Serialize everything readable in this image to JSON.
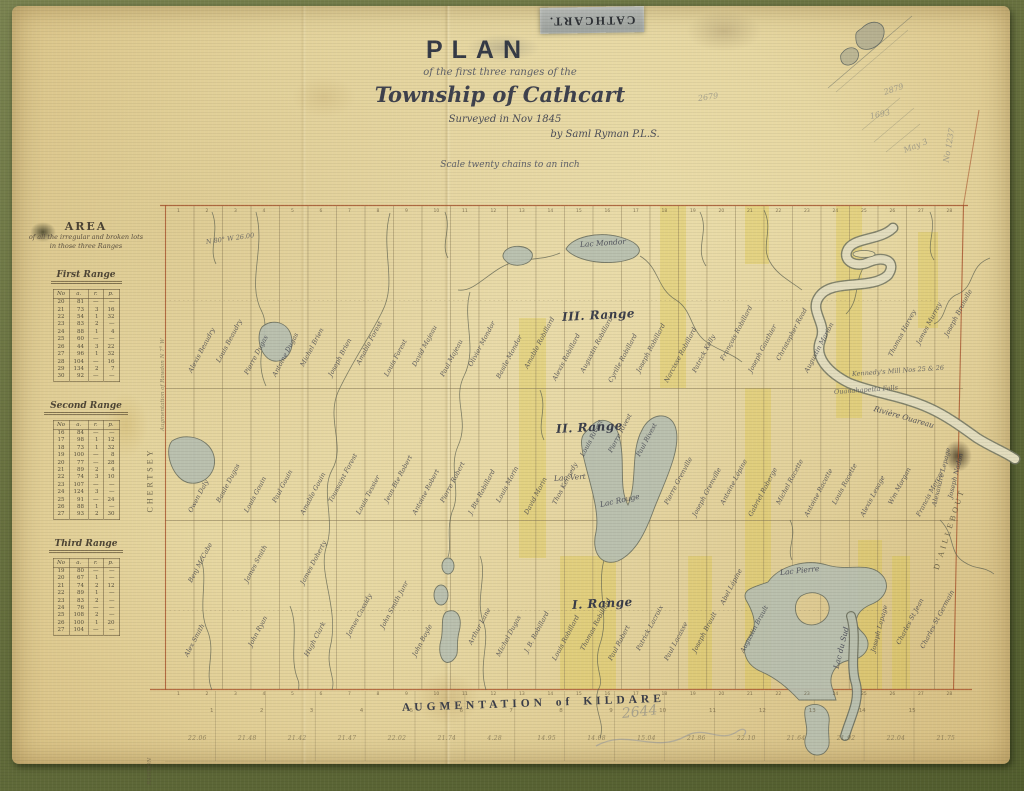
{
  "header": {
    "tape": "CATHCART.",
    "plan": "PLAN",
    "line2": "of the first three ranges of the",
    "township": "Township of Cathcart",
    "surveyed": "Surveyed in Nov 1845",
    "by": "by Saml Ryman P.L.S.",
    "scale": "Scale twenty chains to an inch"
  },
  "area": {
    "title": "AREA",
    "subtitle": "of all the irregular and broken lots",
    "subtitle2": "in those three Ranges",
    "col_no": "No",
    "unit_header": [
      "a.",
      "r.",
      "p."
    ],
    "sections": [
      {
        "name": "First Range",
        "rows": [
          [
            "20",
            "81",
            "—",
            "—"
          ],
          [
            "21",
            "73",
            "3",
            "16"
          ],
          [
            "22",
            "54",
            "1",
            "32"
          ],
          [
            "23",
            "83",
            "2",
            "—"
          ],
          [
            "24",
            "88",
            "1",
            "4"
          ],
          [
            "25",
            "60",
            "—",
            "—"
          ],
          [
            "26",
            "44",
            "3",
            "22"
          ],
          [
            "27",
            "96",
            "1",
            "32"
          ],
          [
            "28",
            "104",
            "—",
            "16"
          ],
          [
            "29",
            "134",
            "2",
            "7"
          ],
          [
            "30",
            "92",
            "—",
            "—"
          ]
        ]
      },
      {
        "name": "Second Range",
        "rows": [
          [
            "16",
            "84",
            "—",
            "—"
          ],
          [
            "17",
            "98",
            "1",
            "12"
          ],
          [
            "18",
            "73",
            "1",
            "32"
          ],
          [
            "19",
            "100",
            "—",
            "8"
          ],
          [
            "20",
            "77",
            "—",
            "28"
          ],
          [
            "21",
            "89",
            "2",
            "4"
          ],
          [
            "22",
            "74",
            "3",
            "10"
          ],
          [
            "23",
            "107",
            "—",
            "—"
          ],
          [
            "24",
            "124",
            "3",
            "—"
          ],
          [
            "25",
            "91",
            "—",
            "24"
          ],
          [
            "26",
            "88",
            "1",
            "—"
          ],
          [
            "27",
            "93",
            "2",
            "30"
          ]
        ]
      },
      {
        "name": "Third Range",
        "rows": [
          [
            "19",
            "80",
            "—",
            "—"
          ],
          [
            "20",
            "67",
            "1",
            "—"
          ],
          [
            "21",
            "74",
            "2",
            "12"
          ],
          [
            "22",
            "89",
            "1",
            "—"
          ],
          [
            "23",
            "83",
            "2",
            "—"
          ],
          [
            "24",
            "76",
            "—",
            "—"
          ],
          [
            "25",
            "108",
            "2",
            "—"
          ],
          [
            "26",
            "100",
            "1",
            "20"
          ],
          [
            "27",
            "104",
            "—",
            "—"
          ]
        ]
      }
    ]
  },
  "map": {
    "labels": [
      {
        "t": "III. Range",
        "x": 562,
        "y": 310,
        "r": -3,
        "c": "range"
      },
      {
        "t": "II. Range",
        "x": 556,
        "y": 422,
        "r": -3,
        "c": "range"
      },
      {
        "t": "I. Range",
        "x": 572,
        "y": 598,
        "r": -3,
        "c": "range"
      },
      {
        "t": "Lac Mondor",
        "x": 580,
        "y": 240,
        "r": -4,
        "c": "lake"
      },
      {
        "t": "Lac Rouge",
        "x": 600,
        "y": 500,
        "r": -12,
        "c": "lake"
      },
      {
        "t": "Lac Vert",
        "x": 554,
        "y": 474,
        "r": -4,
        "c": "lake"
      },
      {
        "t": "Lac Pierre",
        "x": 780,
        "y": 568,
        "r": -6,
        "c": "lake"
      },
      {
        "t": "Lac du Sud",
        "x": 836,
        "y": 664,
        "r": -76,
        "c": "lake"
      },
      {
        "t": "Rivière Ouareau",
        "x": 874,
        "y": 404,
        "r": 16,
        "c": "lake"
      },
      {
        "t": "Kennedy's Mill Nos 25 & 26",
        "x": 852,
        "y": 370,
        "r": -4,
        "c": "note"
      },
      {
        "t": "Ouanahapetta Falls",
        "x": 834,
        "y": 388,
        "r": -4,
        "c": "note"
      },
      {
        "t": "N 80° W 26.00",
        "x": 206,
        "y": 238,
        "r": -8,
        "c": "note"
      },
      {
        "t": "CHERTSEY",
        "x": 150,
        "y": 508,
        "r": -90,
        "c": "margin"
      },
      {
        "t": "Augmentation of Rawdon  N 7° W",
        "x": 163,
        "y": 428,
        "r": -90,
        "c": "tinym"
      },
      {
        "t": "D'AILLEBOUT",
        "x": 936,
        "y": 565,
        "r": -72,
        "c": "margin"
      },
      {
        "t": "RAWDON",
        "x": 150,
        "y": 782,
        "r": -90,
        "c": "tinym"
      },
      {
        "t": "AUGMENTATION of KILDARE",
        "x": 402,
        "y": 702,
        "r": -2,
        "c": "kildare"
      },
      {
        "t": "2879",
        "x": 884,
        "y": 88,
        "r": -18,
        "c": "pencil"
      },
      {
        "t": "1693",
        "x": 870,
        "y": 112,
        "r": -12,
        "c": "pencil"
      },
      {
        "t": "May 3",
        "x": 904,
        "y": 146,
        "r": -22,
        "c": "pencil"
      },
      {
        "t": "No 1237",
        "x": 946,
        "y": 158,
        "r": -80,
        "c": "pencil"
      },
      {
        "t": "2679",
        "x": 698,
        "y": 94,
        "r": -8,
        "c": "pencil"
      },
      {
        "t": "2644",
        "x": 622,
        "y": 706,
        "r": -6,
        "c": "pencil2"
      },
      {
        "t": "Alexandre Lepage",
        "x": 934,
        "y": 502,
        "r": -76,
        "c": "name"
      },
      {
        "t": "Joseph Nadon",
        "x": 950,
        "y": 494,
        "r": -76,
        "c": "name"
      },
      {
        "t": "Alexis Beaudry",
        "x": 190,
        "y": 368,
        "c": "name"
      },
      {
        "t": "Louis Beaudry",
        "x": 218,
        "y": 358,
        "c": "name"
      },
      {
        "t": "Pierre Dugas",
        "x": 246,
        "y": 370,
        "c": "name"
      },
      {
        "t": "Antoine Dugas",
        "x": 274,
        "y": 372,
        "c": "name"
      },
      {
        "t": "Michel Brien",
        "x": 302,
        "y": 362,
        "c": "name"
      },
      {
        "t": "Joseph Brien",
        "x": 330,
        "y": 372,
        "c": "name"
      },
      {
        "t": "Amable Forest",
        "x": 358,
        "y": 360,
        "c": "name"
      },
      {
        "t": "Louis Forest",
        "x": 386,
        "y": 372,
        "c": "name"
      },
      {
        "t": "David Majeau",
        "x": 414,
        "y": 362,
        "c": "name"
      },
      {
        "t": "Paul Majeau",
        "x": 442,
        "y": 372,
        "c": "name"
      },
      {
        "t": "Olivier Mondor",
        "x": 470,
        "y": 362,
        "c": "name"
      },
      {
        "t": "Basile Mondor",
        "x": 498,
        "y": 374,
        "c": "name"
      },
      {
        "t": "Amable Robillard",
        "x": 526,
        "y": 364,
        "c": "name"
      },
      {
        "t": "Alexis Robillard",
        "x": 554,
        "y": 376,
        "c": "name"
      },
      {
        "t": "Augustin Robillard",
        "x": 582,
        "y": 368,
        "c": "name"
      },
      {
        "t": "Cyrille Robillard",
        "x": 610,
        "y": 378,
        "c": "name"
      },
      {
        "t": "Joseph Robillard",
        "x": 638,
        "y": 368,
        "c": "name"
      },
      {
        "t": "Narcisse Robillard",
        "x": 666,
        "y": 378,
        "c": "name"
      },
      {
        "t": "Patrick Kelly",
        "x": 694,
        "y": 368,
        "c": "name"
      },
      {
        "t": "François Robillard",
        "x": 722,
        "y": 356,
        "c": "name"
      },
      {
        "t": "Joseph Gauthier",
        "x": 750,
        "y": 368,
        "c": "name"
      },
      {
        "t": "Christopher Read",
        "x": 778,
        "y": 356,
        "c": "name"
      },
      {
        "t": "Augustin Marion",
        "x": 806,
        "y": 368,
        "c": "name"
      },
      {
        "t": "Thomas Harvey",
        "x": 890,
        "y": 352,
        "c": "name"
      },
      {
        "t": "James Murray",
        "x": 918,
        "y": 340,
        "c": "name"
      },
      {
        "t": "Joseph Brunelle",
        "x": 946,
        "y": 332,
        "c": "name"
      },
      {
        "t": "Owen Daly",
        "x": 190,
        "y": 508,
        "c": "name"
      },
      {
        "t": "Basile Dugas",
        "x": 218,
        "y": 498,
        "c": "name"
      },
      {
        "t": "Louis Gouin",
        "x": 246,
        "y": 508,
        "c": "name"
      },
      {
        "t": "Paul Gouin",
        "x": 274,
        "y": 498,
        "c": "name"
      },
      {
        "t": "Amable Gouin",
        "x": 302,
        "y": 510,
        "c": "name"
      },
      {
        "t": "Toussaint Forest",
        "x": 330,
        "y": 498,
        "c": "name"
      },
      {
        "t": "Louis Tessier",
        "x": 358,
        "y": 510,
        "c": "name"
      },
      {
        "t": "Jean Bte Robert",
        "x": 386,
        "y": 498,
        "c": "name"
      },
      {
        "t": "Antoine Robert",
        "x": 414,
        "y": 510,
        "c": "name"
      },
      {
        "t": "Pierre Robert",
        "x": 442,
        "y": 498,
        "c": "name"
      },
      {
        "t": "J. Bte Robillard",
        "x": 470,
        "y": 510,
        "c": "name"
      },
      {
        "t": "Louis Morin",
        "x": 498,
        "y": 498,
        "c": "name"
      },
      {
        "t": "David Morin",
        "x": 526,
        "y": 510,
        "c": "name"
      },
      {
        "t": "Thos Kennedy",
        "x": 554,
        "y": 500,
        "c": "name"
      },
      {
        "t": "Louis Rivest",
        "x": 582,
        "y": 452,
        "c": "name"
      },
      {
        "t": "Pierre Rivest",
        "x": 610,
        "y": 448,
        "c": "name"
      },
      {
        "t": "Paul Rivest",
        "x": 638,
        "y": 452,
        "c": "name"
      },
      {
        "t": "Pierre Grenville",
        "x": 666,
        "y": 500,
        "c": "name"
      },
      {
        "t": "Joseph Grenville",
        "x": 694,
        "y": 512,
        "c": "name"
      },
      {
        "t": "Antoine Lépine",
        "x": 722,
        "y": 500,
        "c": "name"
      },
      {
        "t": "Gabriel Roberge",
        "x": 750,
        "y": 512,
        "c": "name"
      },
      {
        "t": "Michel Racette",
        "x": 778,
        "y": 500,
        "c": "name"
      },
      {
        "t": "Antoine Racette",
        "x": 806,
        "y": 512,
        "c": "name"
      },
      {
        "t": "Louis Racette",
        "x": 834,
        "y": 500,
        "c": "name"
      },
      {
        "t": "Alexis Lesage",
        "x": 862,
        "y": 512,
        "c": "name"
      },
      {
        "t": "Wm Morgan",
        "x": 890,
        "y": 500,
        "c": "name"
      },
      {
        "t": "Francis Mercer",
        "x": 918,
        "y": 512,
        "c": "name"
      },
      {
        "t": "Alex Smith",
        "x": 186,
        "y": 652,
        "c": "name"
      },
      {
        "t": "Benj McCabe",
        "x": 190,
        "y": 578,
        "c": "name"
      },
      {
        "t": "James Smith",
        "x": 246,
        "y": 578,
        "c": "name"
      },
      {
        "t": "John Ryan",
        "x": 250,
        "y": 642,
        "c": "name"
      },
      {
        "t": "James Doherty",
        "x": 302,
        "y": 580,
        "c": "name"
      },
      {
        "t": "Hugh Clark",
        "x": 306,
        "y": 652,
        "c": "name"
      },
      {
        "t": "James Cassidy",
        "x": 348,
        "y": 632,
        "c": "name"
      },
      {
        "t": "John Smith Junr",
        "x": 382,
        "y": 624,
        "c": "name"
      },
      {
        "t": "John Boyle",
        "x": 414,
        "y": 652,
        "c": "name"
      },
      {
        "t": "Arthur Lane",
        "x": 470,
        "y": 640,
        "c": "name"
      },
      {
        "t": "Michel Dugas",
        "x": 498,
        "y": 652,
        "c": "name"
      },
      {
        "t": "J. B. Robillard",
        "x": 526,
        "y": 648,
        "c": "name"
      },
      {
        "t": "Louis Robillard",
        "x": 554,
        "y": 656,
        "c": "name"
      },
      {
        "t": "Thomas Robillard",
        "x": 582,
        "y": 646,
        "c": "name"
      },
      {
        "t": "Paul Robert",
        "x": 610,
        "y": 656,
        "c": "name"
      },
      {
        "t": "Patrick Lacroix",
        "x": 638,
        "y": 646,
        "c": "name"
      },
      {
        "t": "Paul Lacasse",
        "x": 666,
        "y": 656,
        "c": "name"
      },
      {
        "t": "Joseph Brault",
        "x": 694,
        "y": 648,
        "c": "name"
      },
      {
        "t": "Abel Lépine",
        "x": 722,
        "y": 600,
        "c": "name"
      },
      {
        "t": "Augustin Brault",
        "x": 742,
        "y": 648,
        "c": "name"
      },
      {
        "t": "Joseph Lepage",
        "x": 873,
        "y": 648,
        "r": -75,
        "c": "name"
      },
      {
        "t": "Charles St Jean",
        "x": 898,
        "y": 640,
        "c": "name"
      },
      {
        "t": "Charles St Germain",
        "x": 922,
        "y": 644,
        "c": "name"
      }
    ],
    "number_rows": [
      {
        "y": 209,
        "x0": 177,
        "dx": 28.5,
        "c": "tiny",
        "n": "top-lot-number",
        "values": [
          "1",
          "2",
          "3",
          "4",
          "5",
          "6",
          "7",
          "8",
          "9",
          "10",
          "11",
          "12",
          "13",
          "14",
          "15",
          "16",
          "17",
          "18",
          "19",
          "20",
          "21",
          "22",
          "23",
          "24",
          "25",
          "26",
          "27",
          "28"
        ]
      },
      {
        "y": 692,
        "x0": 177,
        "dx": 28.5,
        "c": "tiny",
        "n": "bottom-lot-number",
        "values": [
          "1",
          "2",
          "3",
          "4",
          "5",
          "6",
          "7",
          "8",
          "9",
          "10",
          "11",
          "12",
          "13",
          "14",
          "15",
          "16",
          "17",
          "18",
          "19",
          "20",
          "21",
          "22",
          "23",
          "24",
          "25",
          "26",
          "27",
          "28"
        ]
      },
      {
        "y": 708,
        "x0": 210,
        "dx": 49.9,
        "c": "tiny2",
        "n": "kildare-lot-number",
        "values": [
          "1",
          "2",
          "3",
          "4",
          "5",
          "6",
          "7",
          "8",
          "9",
          "10",
          "11",
          "12",
          "13",
          "14",
          "15"
        ]
      },
      {
        "y": 735,
        "x0": 188,
        "dx": 49.9,
        "c": "acre",
        "n": "kildare-lot-acreage",
        "values": [
          "22.06",
          "21.48",
          "21.42",
          "21.47",
          "22.02",
          "21.74",
          "4.28",
          "14.95",
          "14.08",
          "15.04",
          "21.86",
          "22.10",
          "21.64",
          "21.92",
          "22.04",
          "21.75"
        ]
      }
    ]
  }
}
